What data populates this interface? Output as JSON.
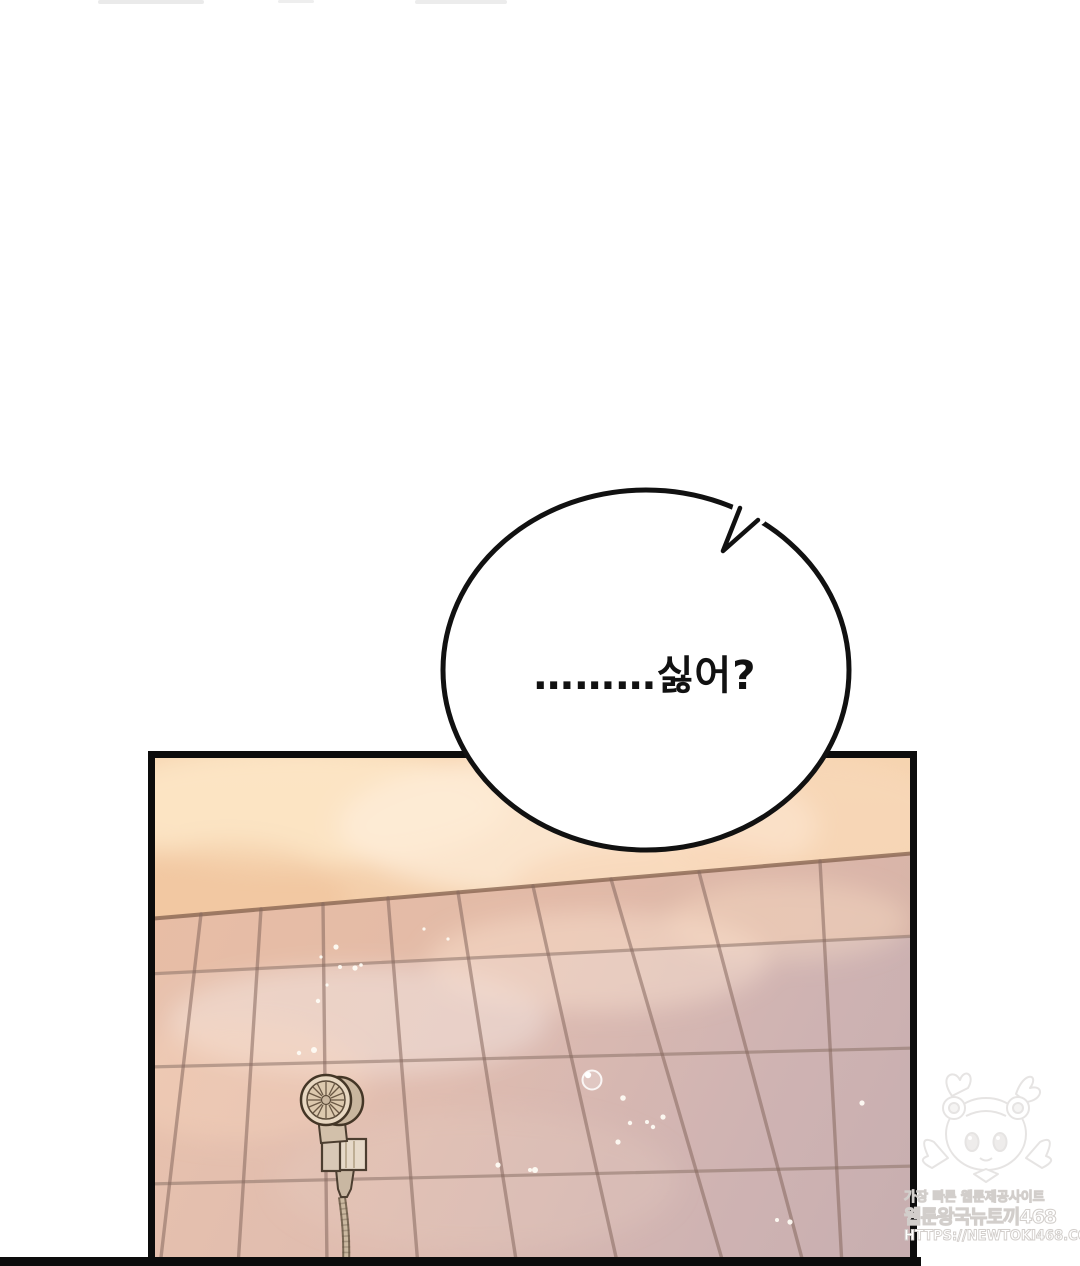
{
  "page": {
    "type": "webtoon-comic-panel",
    "bubble": {
      "text": "………싫어?"
    },
    "watermark": {
      "tagline": "가장 빠른 웹툰제공사이트",
      "site_name": "웹툰왕국뉴토끼468",
      "url": "HTTPS://NEWTOKI468.COM"
    },
    "colors": {
      "panel_border": "#0c0c0c",
      "bubble_outline": "#111111",
      "steam_top": "#f6d3ae",
      "steam_glow": "#feeedb",
      "tile_light": "#e9c2ac",
      "tile_dark": "#c7aeb0",
      "grout": "#8d7268",
      "shower_metal": "#e8d8c2",
      "watermark_ink": "#d2cecb"
    }
  }
}
